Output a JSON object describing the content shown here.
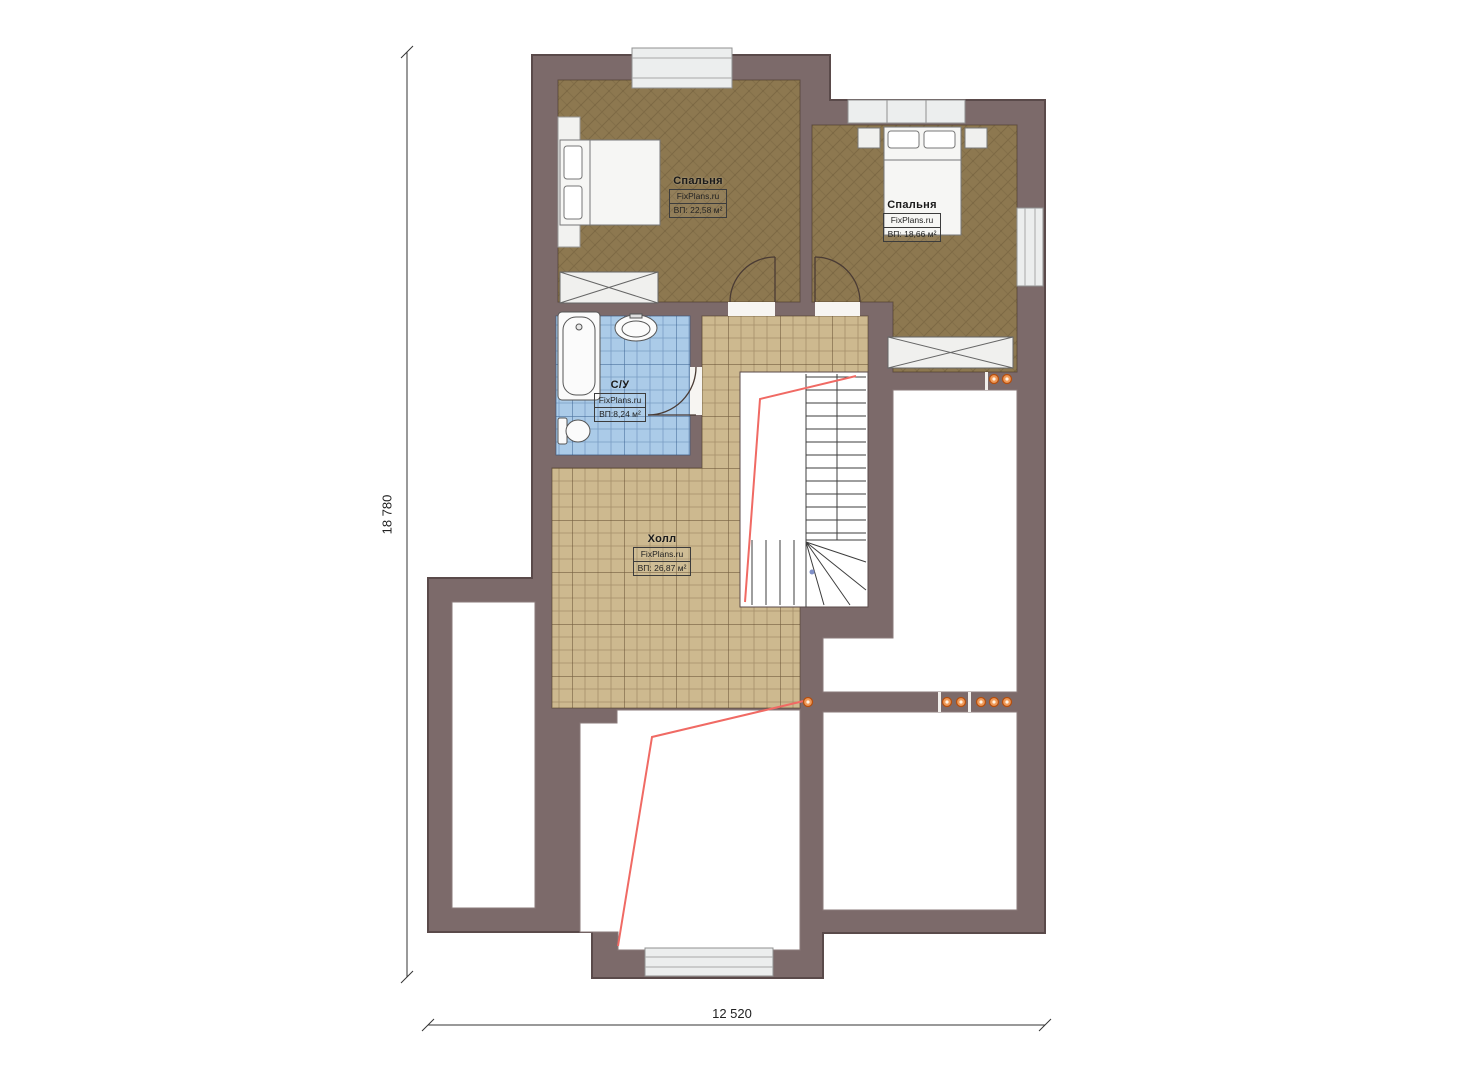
{
  "plan": {
    "title": "Floor plan (attic level)",
    "brand": "FixPlans.ru",
    "rooms": {
      "bedroom1": {
        "name": "Спальня",
        "brand": "FixPlans.ru",
        "area": "ВП: 22,58 м²"
      },
      "bedroom2": {
        "name": "Спальня",
        "brand": "FixPlans.ru",
        "area": "ВП: 18,66 м²"
      },
      "bathroom": {
        "name": "С/У",
        "brand": "FixPlans.ru",
        "area": "ВП:8,24 м²"
      },
      "hall": {
        "name": "Холл",
        "brand": "FixPlans.ru",
        "area": "ВП: 26,87 м²"
      }
    },
    "dimensions": {
      "overall_height_mm": "18 780",
      "overall_width_mm": "12 520"
    },
    "colors": {
      "wall": "#7c6a6a",
      "wall_outline": "#5a4a4a",
      "wood_floor": "#8d7850",
      "tile_floor": "#cdb98f",
      "bath_tile": "#abcbe8",
      "white_room": "#ffffff",
      "window_fill": "#eceeee",
      "slope_line": "#f06a64",
      "vent_dot": "#f09a58",
      "vent_dot_ring": "#b44f10",
      "background": "#ffffff"
    }
  }
}
